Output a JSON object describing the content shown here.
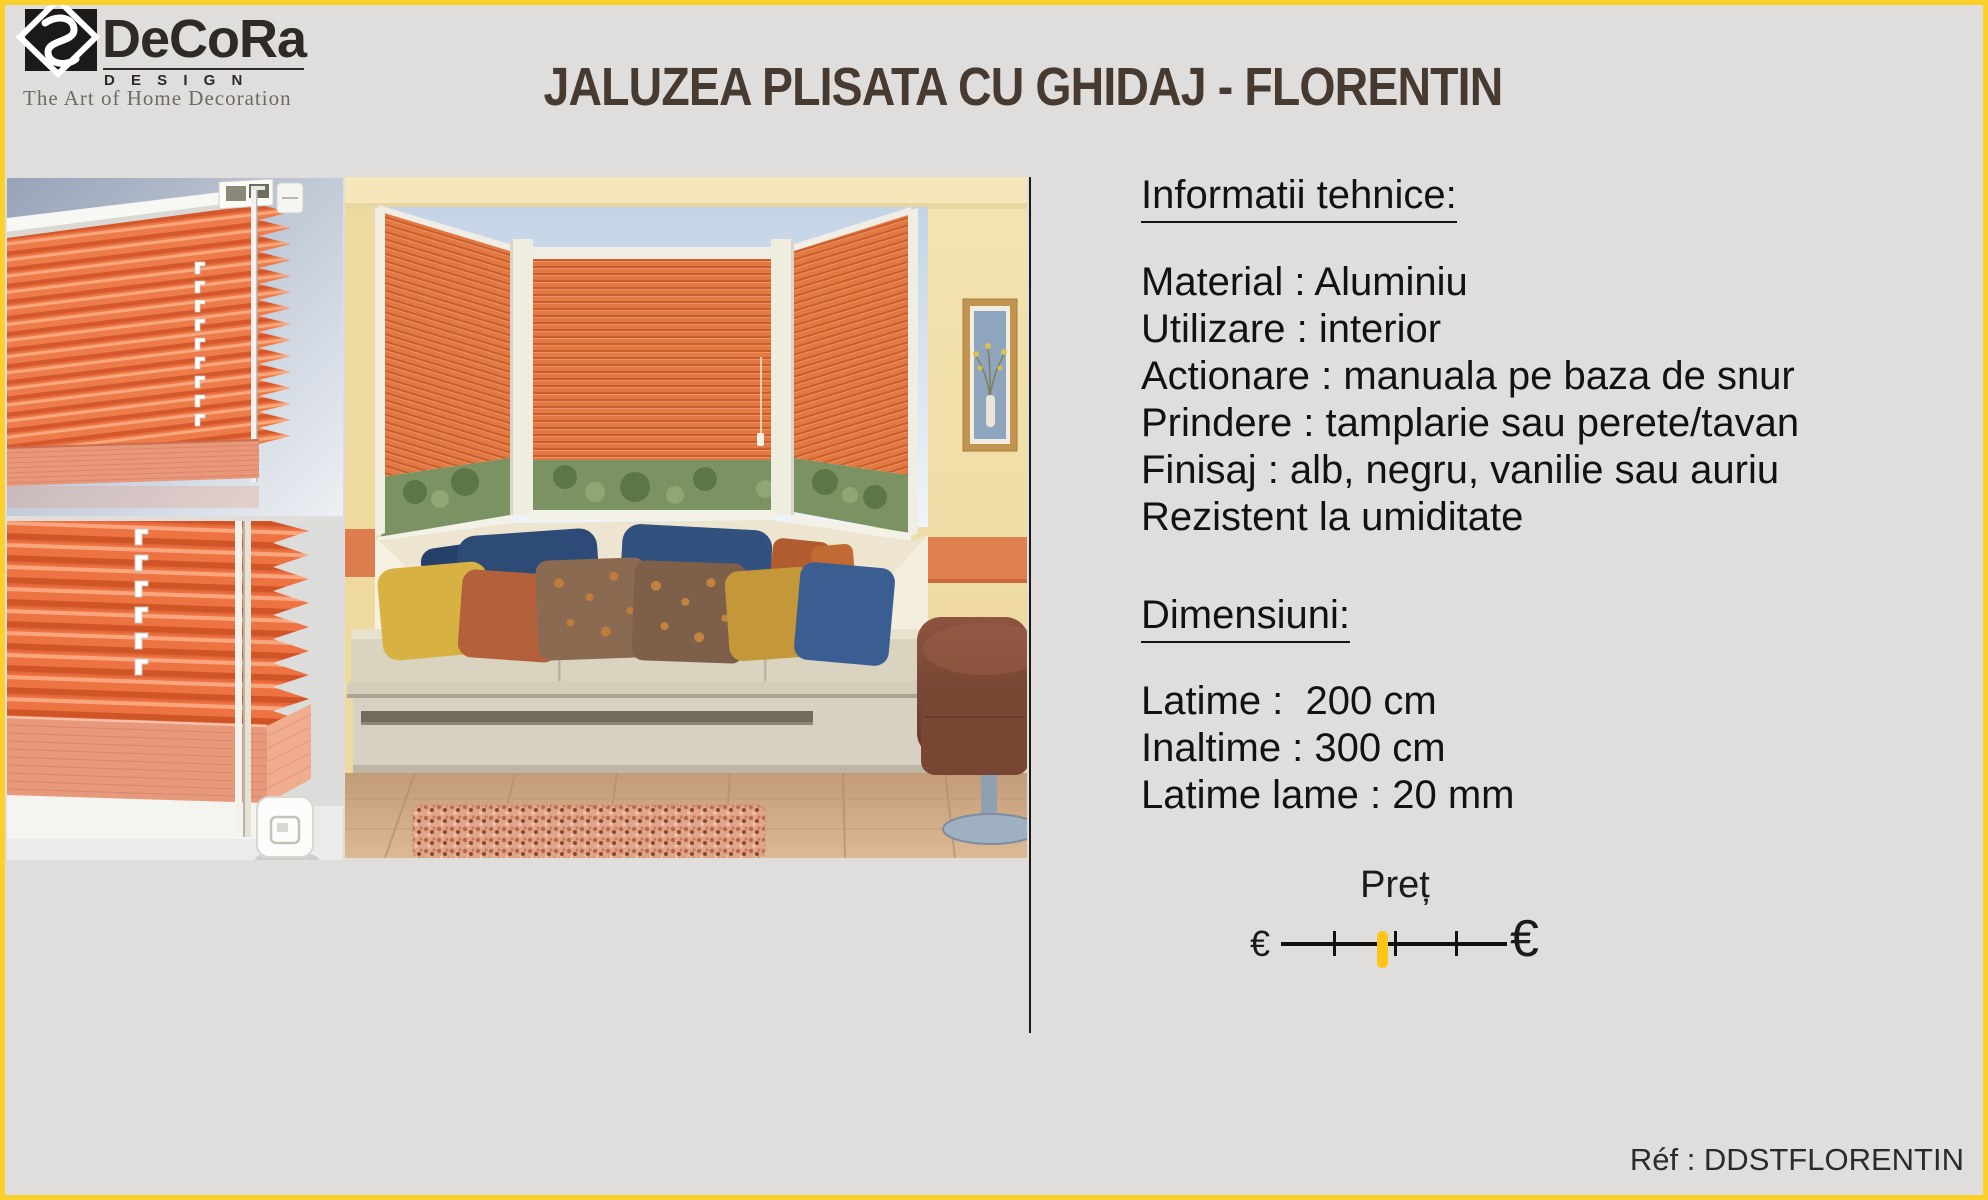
{
  "logo": {
    "brand": "DeCoRa",
    "design_word": "D E S I G N",
    "tagline": "The Art of Home Decoration"
  },
  "header": {
    "title": "JALUZEA PLISATA CU GHIDAJ - FLORENTIN"
  },
  "gallery": {
    "product_top_alt": "orange pleated blind with white head rail and side guide cord",
    "product_bottom_alt": "close-up of pleated blind bottom rail with white handle",
    "room_alt": "bay window with three orange pleated blinds above a cushioned window seat"
  },
  "tech_info": {
    "heading": "Informatii tehnice:",
    "lines": [
      "Material : Aluminiu",
      "Utilizare : interior",
      "Actionare : manuala pe baza de snur",
      "Prindere : tamplarie sau perete/tavan",
      "Finisaj : alb, negru, vanilie sau auriu",
      "Rezistent la umiditate"
    ]
  },
  "dimensions": {
    "heading": "Dimensiuni:",
    "lines": [
      "Latime :  200 cm",
      "Inaltime : 300 cm",
      "Latime lame : 20 mm"
    ]
  },
  "price": {
    "label": "Preț",
    "min_symbol": "€",
    "max_symbol": "€",
    "marker_color": "#ffc516",
    "marker_position_pct": 45
  },
  "footer": {
    "reference": "Réf : DDSTFLORENTIN"
  },
  "colors": {
    "page_background": "#e0dedc",
    "frame_border": "#fcd02b",
    "title_text": "#473a31",
    "body_text": "#121212",
    "blind_orange": "#ee7c4a"
  }
}
